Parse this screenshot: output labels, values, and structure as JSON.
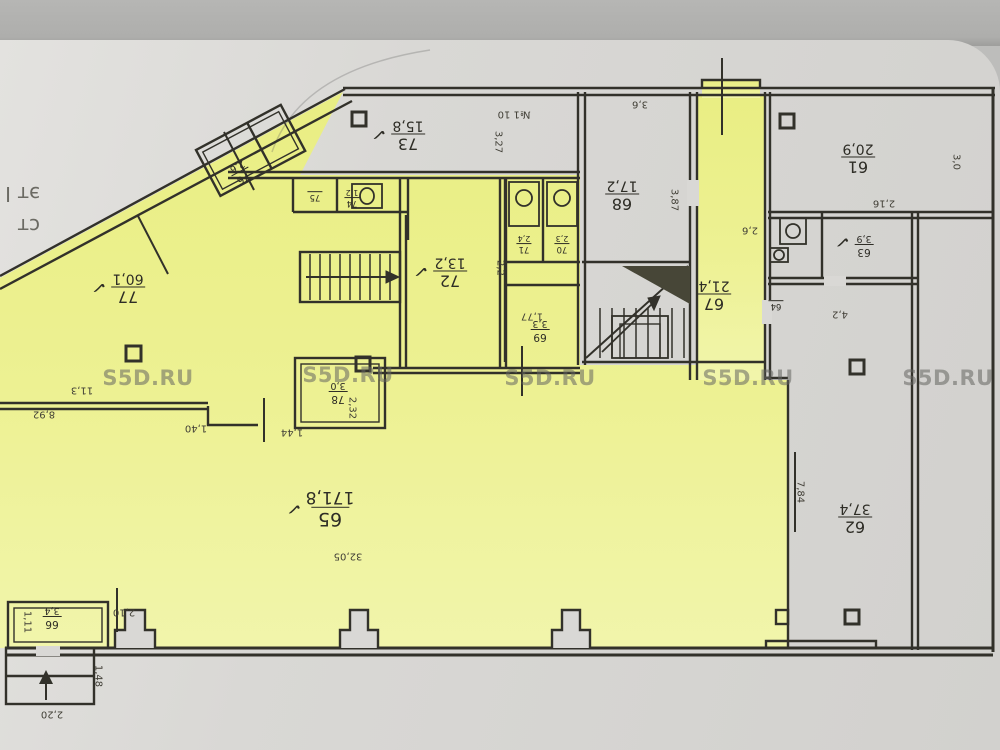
{
  "watermark": {
    "text": "S5D.RU"
  },
  "edge_text": {
    "line1": "ст",
    "line2": "эт I"
  },
  "marks": {
    "check": "✓"
  },
  "rooms": {
    "r61": {
      "number": "61",
      "area": "20,9"
    },
    "r62": {
      "number": "62",
      "area": "37,4"
    },
    "r63": {
      "number": "63",
      "area": "3,9"
    },
    "r64": {
      "number": "64",
      "area": ""
    },
    "r65": {
      "number": "65",
      "area": "171,8"
    },
    "r66": {
      "number": "66",
      "area": "3,4"
    },
    "r67": {
      "number": "67",
      "area": "21,4"
    },
    "r68": {
      "number": "68",
      "area": "17,2"
    },
    "r69": {
      "number": "69",
      "area": "3,3"
    },
    "r70": {
      "number": "70",
      "area": "2,3"
    },
    "r71": {
      "number": "71",
      "area": "2,4"
    },
    "r72": {
      "number": "72",
      "area": "13,2"
    },
    "r73": {
      "number": "73",
      "area": "15,8"
    },
    "r74": {
      "number": "74",
      "area": "1,2"
    },
    "r75": {
      "number": "75",
      "area": ""
    },
    "r76": {
      "number": "76",
      "area": "2,6"
    },
    "r77": {
      "number": "77",
      "area": "60,1"
    },
    "r78": {
      "number": "78",
      "area": "3,0"
    }
  },
  "dims": {
    "d1": "3,6",
    "d2": "№1 10",
    "d3": "3,27",
    "d4": "3,87",
    "d5": "2,6",
    "d6": "2,16",
    "d7": "3,0",
    "d8": "4,2",
    "d9": "7,84",
    "d10": "11,3",
    "d11": "8,92",
    "d12": "1,40",
    "d13": "1,44",
    "d14": "2,32",
    "d15": "32,05",
    "d16": "2,10",
    "d17": "1,11",
    "d18": "2,20",
    "d19": "1,48",
    "d20": "2,2",
    "d21": "1,77"
  }
}
